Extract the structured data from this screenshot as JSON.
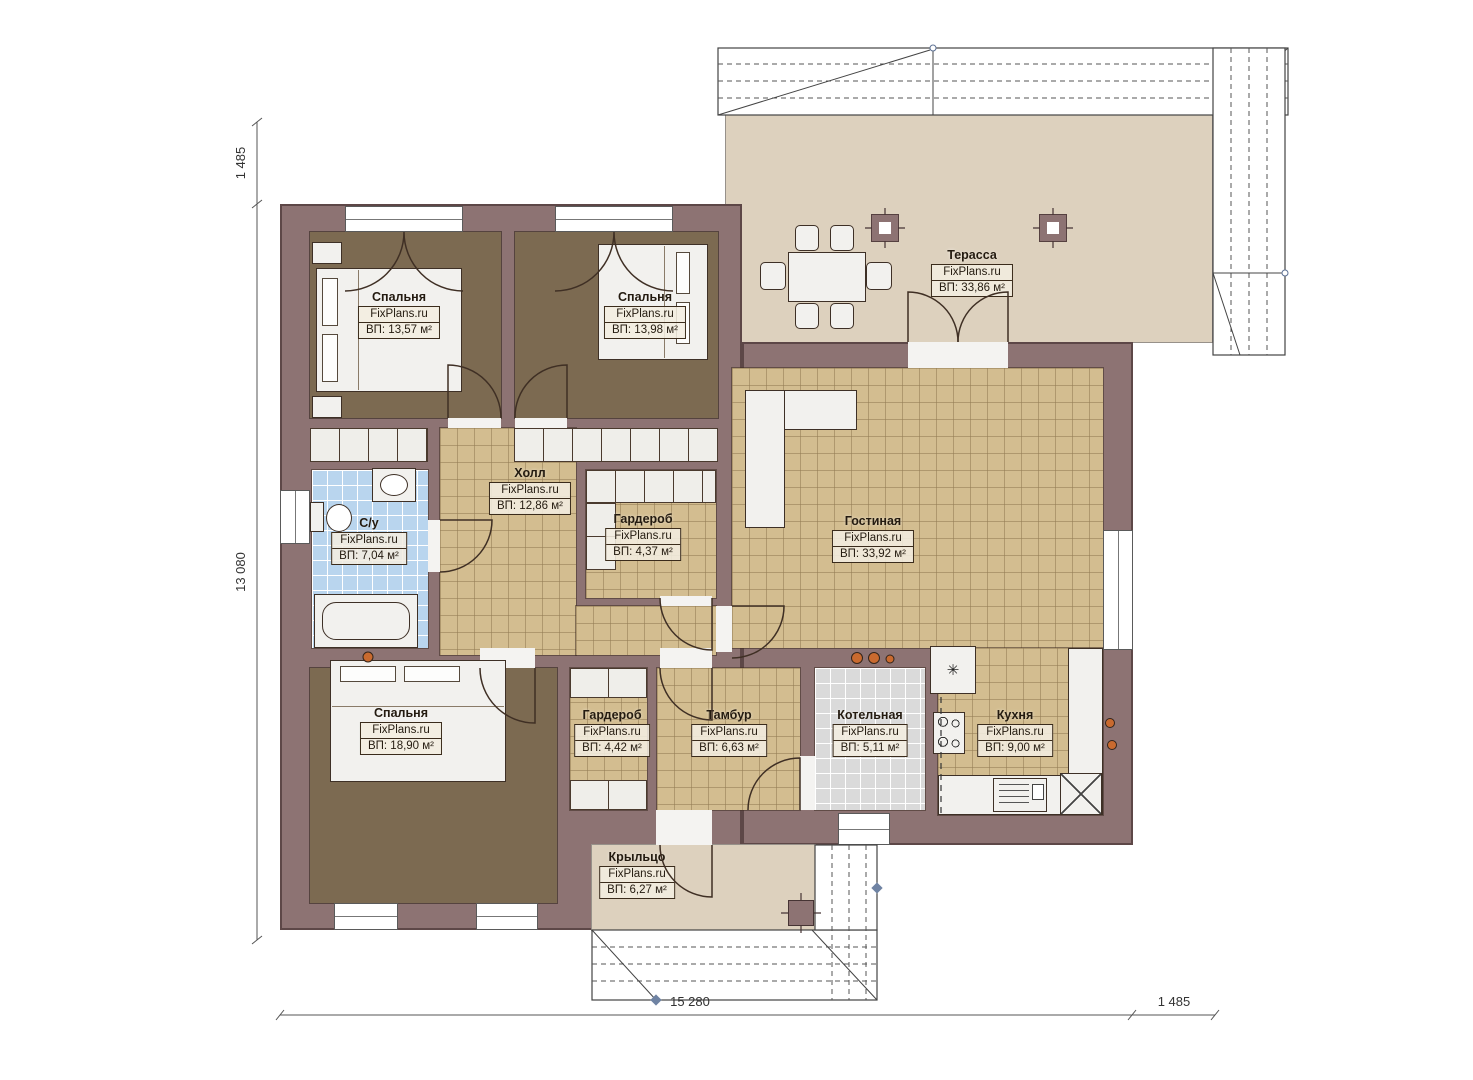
{
  "brand": "FixPlans.ru",
  "rooms": [
    {
      "id": "bedroom-1",
      "name": "Спальня",
      "area": "ВП: 13,57 м²"
    },
    {
      "id": "bedroom-2",
      "name": "Спальня",
      "area": "ВП: 13,98 м²"
    },
    {
      "id": "terrace",
      "name": "Терасса",
      "area": "ВП: 33,86 м²"
    },
    {
      "id": "hall",
      "name": "Холл",
      "area": "ВП: 12,86 м²"
    },
    {
      "id": "bathroom",
      "name": "С/у",
      "area": "ВП: 7,04 м²"
    },
    {
      "id": "wardrobe-1",
      "name": "Гардероб",
      "area": "ВП: 4,37 м²"
    },
    {
      "id": "living",
      "name": "Гостиная",
      "area": "ВП: 33,92 м²"
    },
    {
      "id": "bedroom-3",
      "name": "Спальня",
      "area": "ВП: 18,90 м²"
    },
    {
      "id": "wardrobe-2",
      "name": "Гардероб",
      "area": "ВП: 4,42 м²"
    },
    {
      "id": "tambour",
      "name": "Тамбур",
      "area": "ВП: 6,63 м²"
    },
    {
      "id": "boiler",
      "name": "Котельная",
      "area": "ВП: 5,11 м²"
    },
    {
      "id": "kitchen",
      "name": "Кухня",
      "area": "ВП: 9,00 м²"
    },
    {
      "id": "porch",
      "name": "Крыльцо",
      "area": "ВП: 6,27 м²"
    }
  ],
  "dims": {
    "top_left": "1 485",
    "left": "13 080",
    "bottom": "15 280",
    "bottom_right": "1 485"
  },
  "icons": {
    "fridge": "✳"
  },
  "colors": {
    "wall": "#8d7373",
    "bedroom_floor": "#7c6a51",
    "tile_tan": "#d3bd90",
    "tile_blue": "#b9d5ee",
    "tile_gray": "#dadada",
    "outdoor": "#ddd1be",
    "spotlight": "#c96a2f"
  }
}
